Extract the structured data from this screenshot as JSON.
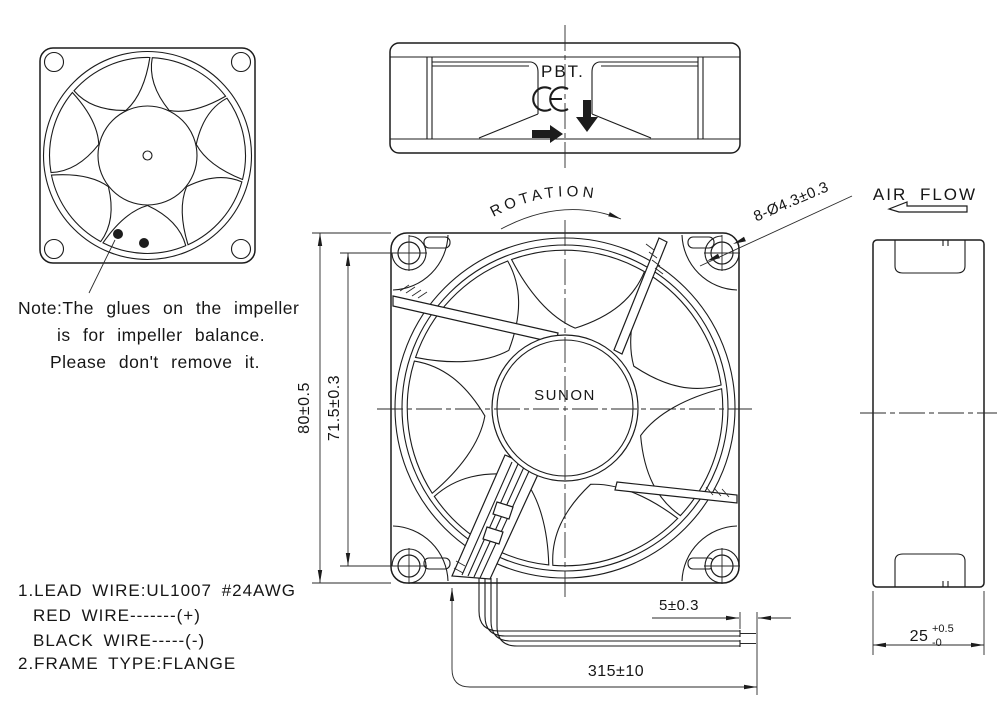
{
  "drawing": {
    "note": {
      "line1": "Note:The glues on the impeller",
      "line2": "is for impeller balance.",
      "line3": "Please don't remove it."
    },
    "specs": {
      "line1": "1.LEAD WIRE:UL1007 #24AWG",
      "line2": "RED WIRE-------(+)",
      "line3": "BLACK WIRE-----(-)",
      "line4": "2.FRAME TYPE:FLANGE"
    },
    "labels": {
      "material": "PBT.",
      "ce_mark": "CE",
      "rotation": "ROTATION",
      "air_flow": "AIR FLOW",
      "brand": "SUNON"
    },
    "dimensions": {
      "width": "80±0.5",
      "hole_pitch": "71.5±0.3",
      "mounting_holes": "8-Ø4.3±0.3",
      "strip_length": "5±0.3",
      "lead_length": "315±10",
      "depth": "25",
      "depth_tol_plus": "+0.5",
      "depth_tol_minus": "-0"
    },
    "colors": {
      "line": "#1c1c1c",
      "background": "#ffffff"
    }
  }
}
